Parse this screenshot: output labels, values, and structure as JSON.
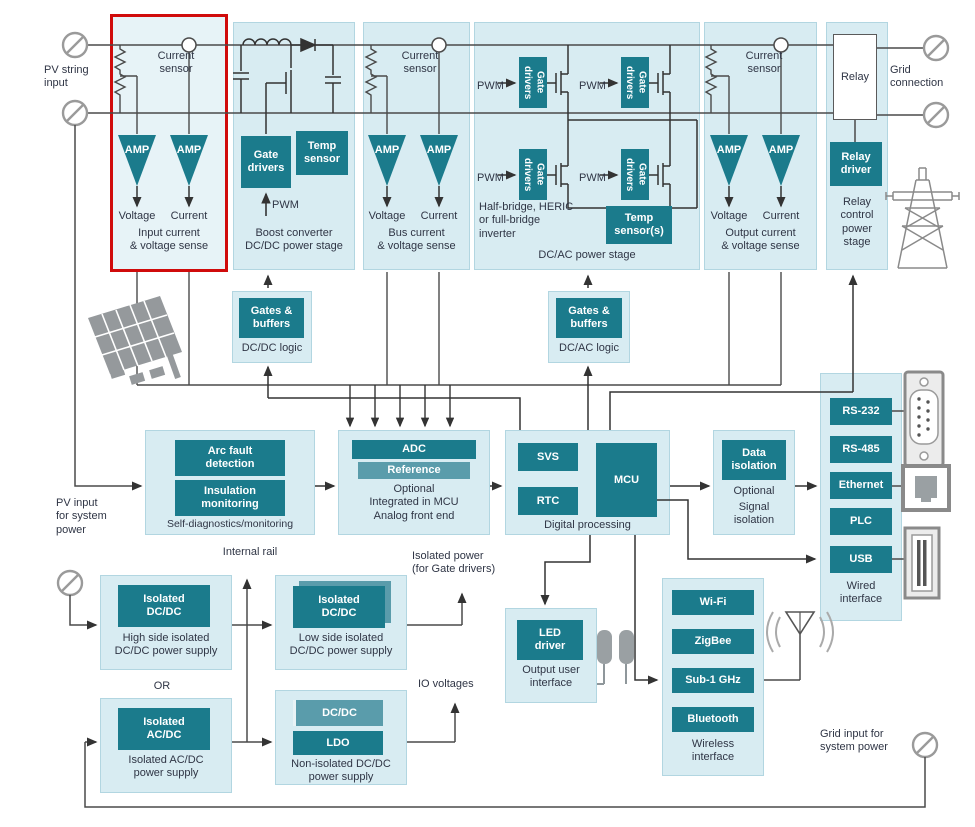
{
  "diagram": {
    "pv_string_input": "PV string\ninput",
    "grid_connection": "Grid\nconnection",
    "pv_system_note": "PV input\nfor system\npower",
    "grid_system_note": "Grid input for\nsystem power",
    "internal_rail": "Internal rail",
    "isolated_power_note": "Isolated power\n(for Gate drivers)",
    "or": "OR",
    "io_voltages": "IO voltages",
    "amp": "AMP",
    "pwm": "PWM",
    "voltage": "Voltage",
    "current": "Current",
    "current_sensor": "Current\nsensor"
  },
  "stages": {
    "input_sense": {
      "caption": "Input current\n& voltage sense"
    },
    "boost": {
      "gate_drivers": "Gate\ndrivers",
      "temp_sensor": "Temp\nsensor",
      "caption": "Boost converter\nDC/DC power stage"
    },
    "bus_sense": {
      "caption": "Bus current\n& voltage sense"
    },
    "dcac": {
      "gate_drivers": "Gate drivers",
      "inverter_note": "Half-bridge, HERIC\nor full-bridge\ninverter",
      "temp_sensor": "Temp\nsensor(s)",
      "caption": "DC/AC power stage"
    },
    "output_sense": {
      "caption": "Output current\n& voltage sense"
    },
    "relay": {
      "relay": "Relay",
      "driver": "Relay\ndriver",
      "caption": "Relay\ncontrol\npower\nstage"
    }
  },
  "logic": {
    "gates_buffers": "Gates &\nbuffers",
    "dcdc_caption": "DC/DC logic",
    "dcac_caption": "DC/AC logic"
  },
  "processing": {
    "selfdiag": {
      "arc": "Arc fault\ndetection",
      "insulation": "Insulation\nmonitoring",
      "caption": "Self-diagnostics/monitoring"
    },
    "afe": {
      "adc": "ADC",
      "reference": "Reference",
      "note": "Optional\nIntegrated in MCU\nAnalog front end"
    },
    "digital": {
      "svs": "SVS",
      "rtc": "RTC",
      "mcu": "MCU",
      "caption": "Digital processing"
    },
    "isolation": {
      "box": "Data\nisolation",
      "note": "Optional",
      "caption": "Signal\nisolation"
    }
  },
  "wired": {
    "items": [
      "RS-232",
      "RS-485",
      "Ethernet",
      "PLC",
      "USB"
    ],
    "caption": "Wired\ninterface"
  },
  "wireless": {
    "items": [
      "Wi-Fi",
      "ZigBee",
      "Sub-1 GHz",
      "Bluetooth"
    ],
    "caption": "Wireless\ninterface"
  },
  "power": {
    "high": {
      "box": "Isolated\nDC/DC",
      "caption": "High side isolated\nDC/DC power supply"
    },
    "low": {
      "box": "Isolated\nDC/DC",
      "caption": "Low side isolated\nDC/DC power supply"
    },
    "acdc": {
      "box": "Isolated\nAC/DC",
      "caption": "Isolated AC/DC\npower supply"
    },
    "noniso": {
      "dcdc": "DC/DC",
      "ldo": "LDO",
      "caption": "Non-isolated DC/DC\npower supply"
    }
  },
  "ui_block": {
    "led": "LED\ndriver",
    "caption": "Output user\ninterface"
  },
  "colors": {
    "teal": "#1b7b8c",
    "teal_light": "#5a9cab",
    "panel": "#d8ecf2",
    "panel_border": "#b2d6e1",
    "highlight": "#d00b0b",
    "wire": "#4a4a4a"
  }
}
